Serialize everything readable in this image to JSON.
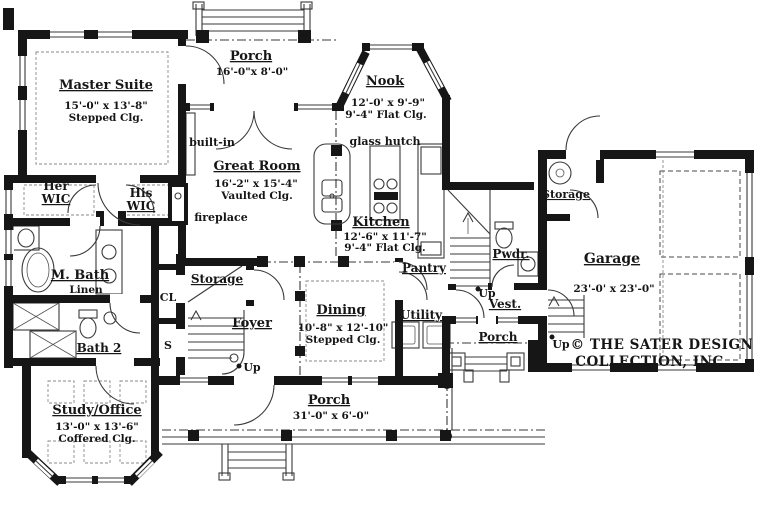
{
  "plan": {
    "rooms": {
      "master_suite": {
        "name": "Master Suite",
        "dims": "15'-0\" x 13'-8\"",
        "ceiling": "Stepped Clg."
      },
      "porch_top": {
        "name": "Porch",
        "dims": "16'-0\"x 8'-0\""
      },
      "nook": {
        "name": "Nook",
        "dims": "12'-0' x 9'-9\"",
        "ceiling": "9'-4\" Flat Clg."
      },
      "great_room": {
        "name": "Great Room",
        "dims": "16'-2\" x 15'-4\"",
        "ceiling": "Vaulted Clg."
      },
      "kitchen": {
        "name": "Kitchen",
        "dims": "12'-6\" x 11'-7\"",
        "ceiling": "9'-4\" Flat Clg."
      },
      "her_wic": {
        "line1": "Her",
        "line2": "WIC"
      },
      "his_wic": {
        "line1": "His",
        "line2": "WIC"
      },
      "m_bath": {
        "name": "M. Bath"
      },
      "bath_2": {
        "name": "Bath 2"
      },
      "study_office": {
        "name": "Study/Office",
        "dims": "13'-0\" x 13'-6\"",
        "ceiling": "Coffered Clg."
      },
      "foyer": {
        "name": "Foyer"
      },
      "storage_foyer": {
        "name": "Storage"
      },
      "dining": {
        "name": "Dining",
        "dims": "10'-8\" x 12'-10\"",
        "ceiling": "Stepped Clg."
      },
      "porch_front": {
        "name": "Porch",
        "dims": "31'-0\" x 6'-0\""
      },
      "pantry": {
        "name": "Pantry"
      },
      "utility": {
        "name": "Utility"
      },
      "pwdr": {
        "name": "Pwdr."
      },
      "vest": {
        "name": "Vest."
      },
      "porch_rear": {
        "name": "Porch"
      },
      "storage_garage": {
        "name": "Storage"
      },
      "garage": {
        "name": "Garage",
        "dims": "23'-0' x 23'-0\""
      }
    },
    "labels": {
      "built_in": "built-in",
      "glass_hutch": "glass hutch",
      "fireplace": "fireplace",
      "linen": "Linen",
      "cl": "CL",
      "s": "S",
      "up": "Up"
    },
    "copyright": {
      "line1": "© THE SATER DESIGN",
      "line2": "COLLECTION, INC."
    },
    "colors": {
      "wall": "#161616",
      "line": "#3a3a3a",
      "bg": "#ffffff"
    }
  }
}
